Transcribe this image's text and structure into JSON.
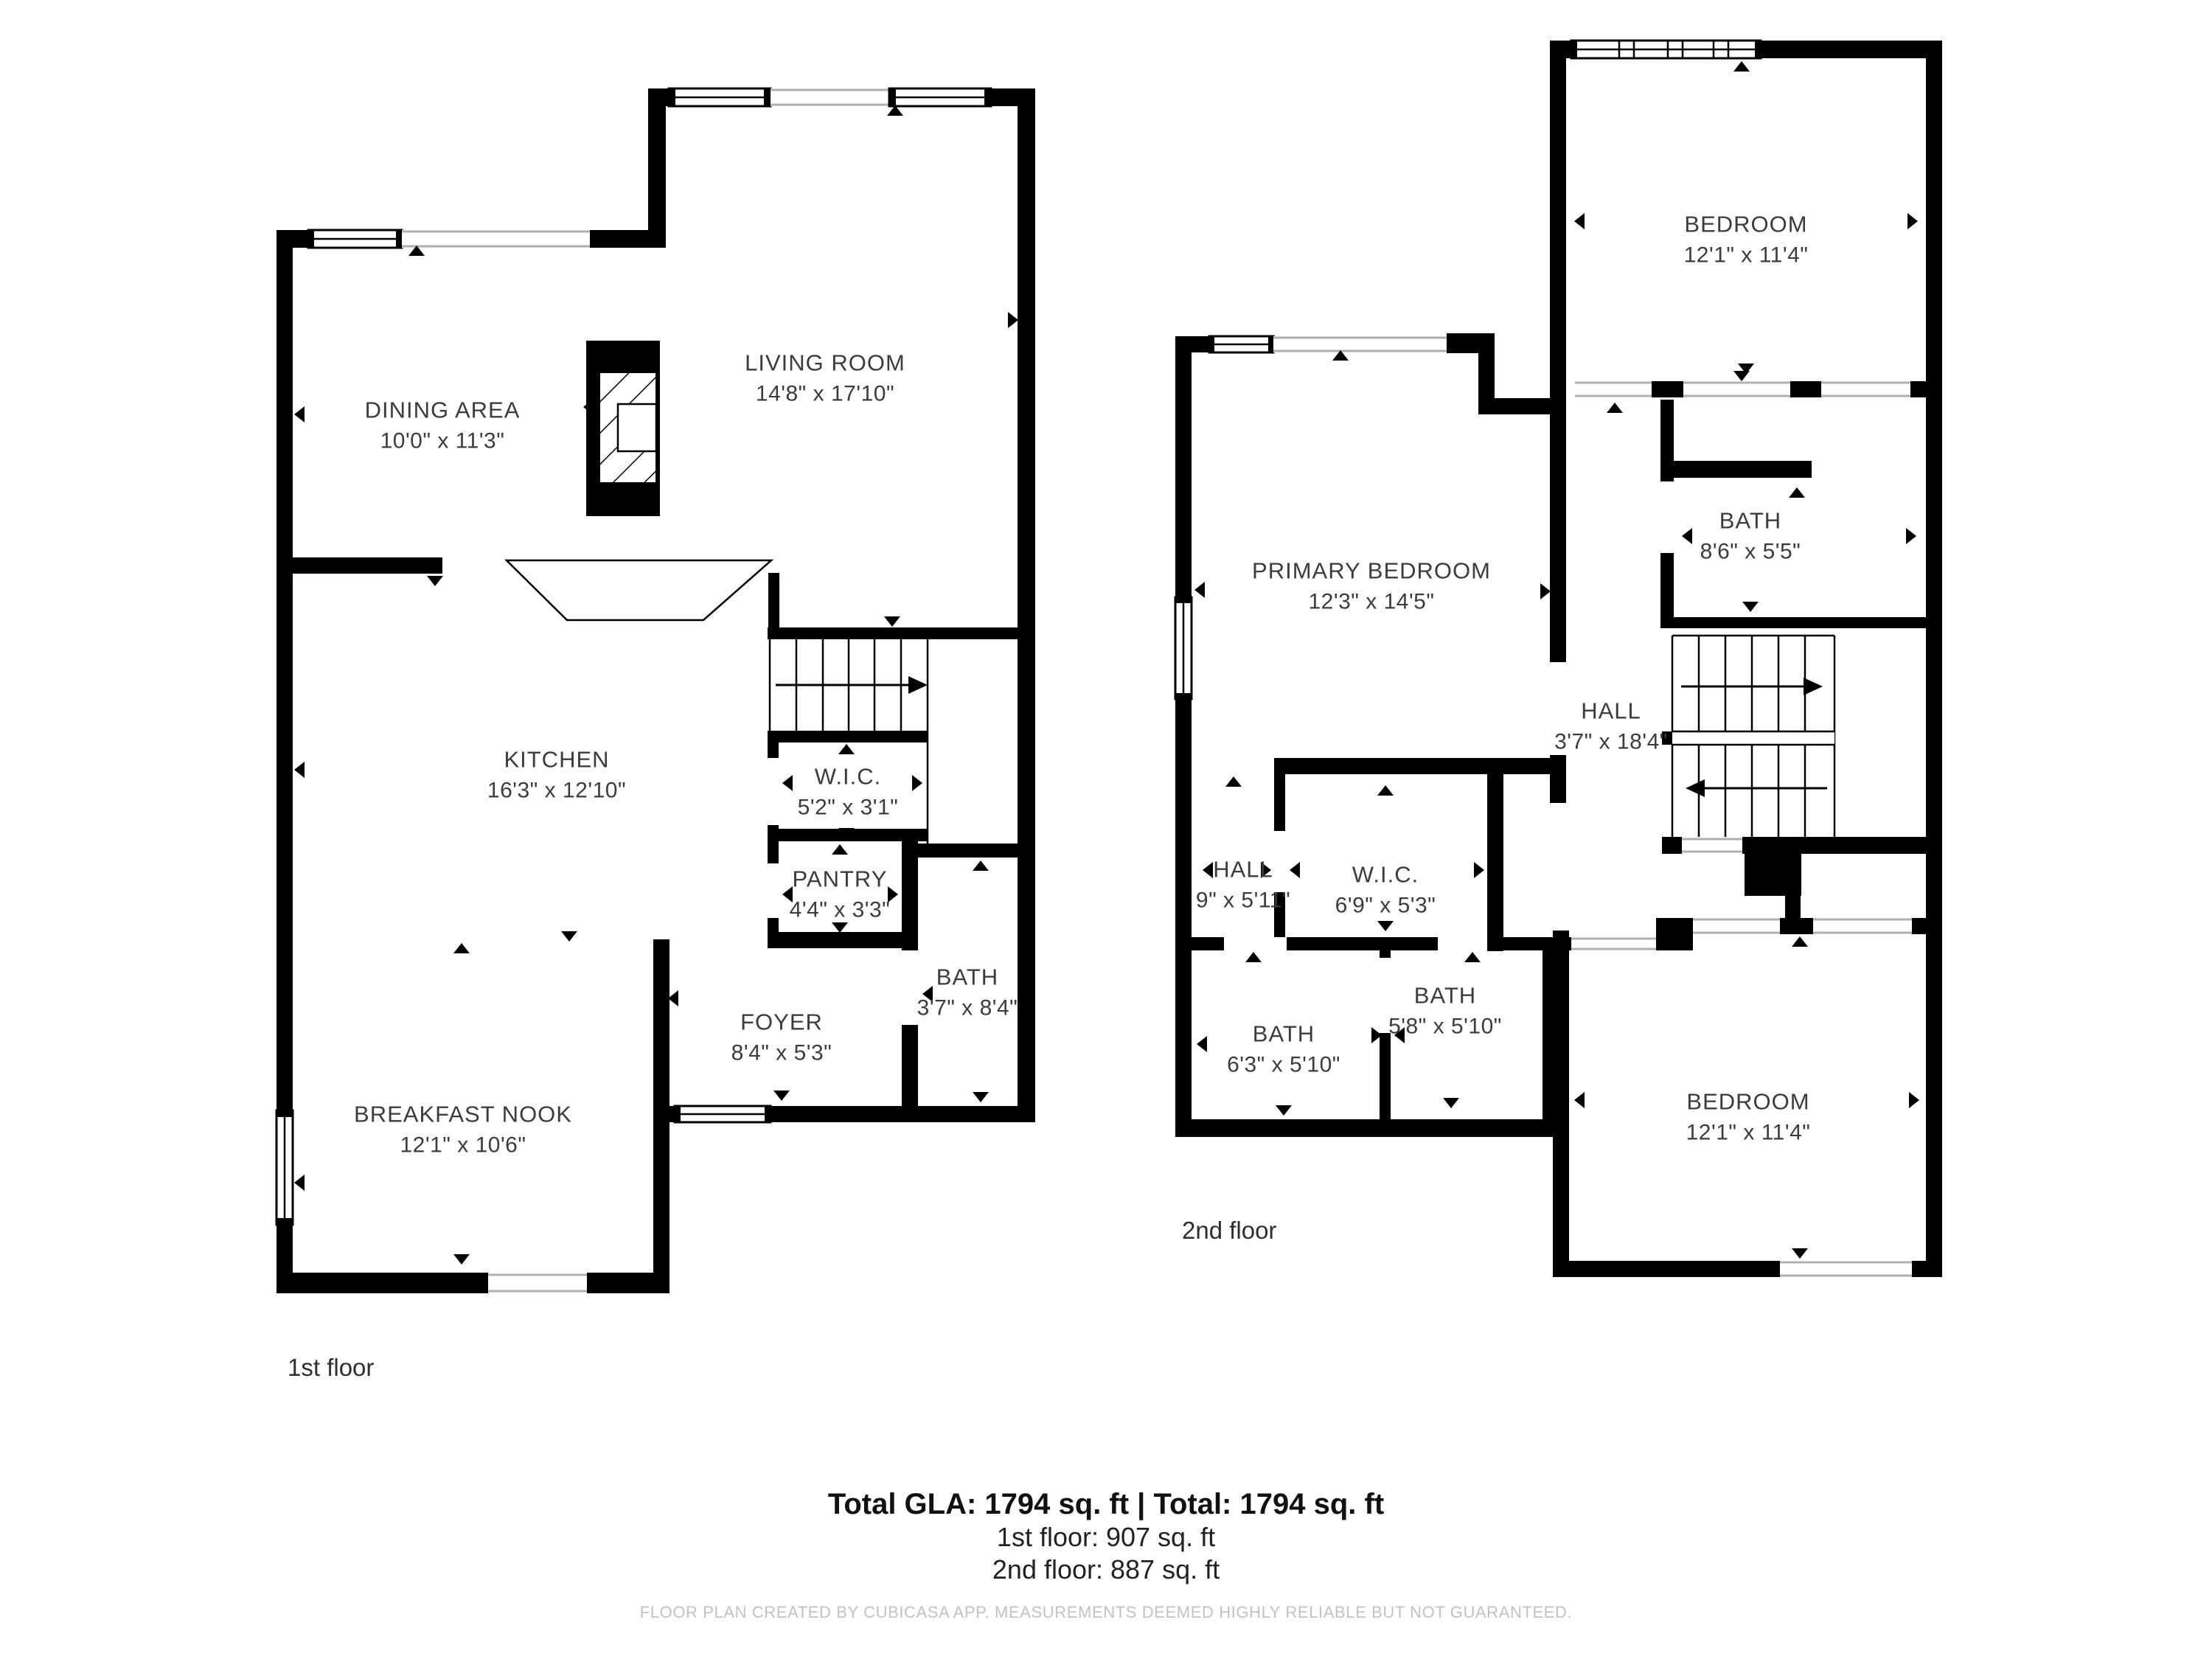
{
  "floor1": {
    "label": "1st floor",
    "rooms": [
      {
        "name": "DINING AREA",
        "dims": "10'0\" x 11'3\""
      },
      {
        "name": "LIVING ROOM",
        "dims": "14'8\" x 17'10\""
      },
      {
        "name": "KITCHEN",
        "dims": "16'3\" x 12'10\""
      },
      {
        "name": "W.I.C.",
        "dims": "5'2\" x 3'1\""
      },
      {
        "name": "PANTRY",
        "dims": "4'4\" x 3'3\""
      },
      {
        "name": "BATH",
        "dims": "3'7\" x 8'4\""
      },
      {
        "name": "FOYER",
        "dims": "8'4\" x 5'3\""
      },
      {
        "name": "BREAKFAST NOOK",
        "dims": "12'1\" x 10'6\""
      }
    ]
  },
  "floor2": {
    "label": "2nd floor",
    "rooms": [
      {
        "name": "BEDROOM",
        "dims": "12'1\" x 11'4\""
      },
      {
        "name": "PRIMARY BEDROOM",
        "dims": "12'3\" x 14'5\""
      },
      {
        "name": "BATH",
        "dims": "8'6\" x 5'5\""
      },
      {
        "name": "HALL",
        "dims": "3'7\" x 18'4\""
      },
      {
        "name": "HALL",
        "dims": "9\" x 5'11\""
      },
      {
        "name": "W.I.C.",
        "dims": "6'9\" x 5'3\""
      },
      {
        "name": "BATH",
        "dims": "5'8\" x 5'10\""
      },
      {
        "name": "BATH",
        "dims": "6'3\" x 5'10\""
      },
      {
        "name": "BEDROOM",
        "dims": "12'1\" x 11'4\""
      }
    ]
  },
  "footer": {
    "total_line": "Total GLA: 1794 sq. ft | Total: 1794 sq. ft",
    "floor1_line": "1st floor: 907 sq. ft",
    "floor2_line": "2nd floor: 887 sq. ft",
    "disclaimer": "FLOOR PLAN CREATED BY CUBICASA APP. MEASUREMENTS DEEMED HIGHLY RELIABLE BUT NOT GUARANTEED."
  },
  "colors": {
    "wall": "#000000",
    "room_text": "#3c3c3c",
    "footer_text": "#111111",
    "disclaimer_text": "#c2c2c2"
  }
}
